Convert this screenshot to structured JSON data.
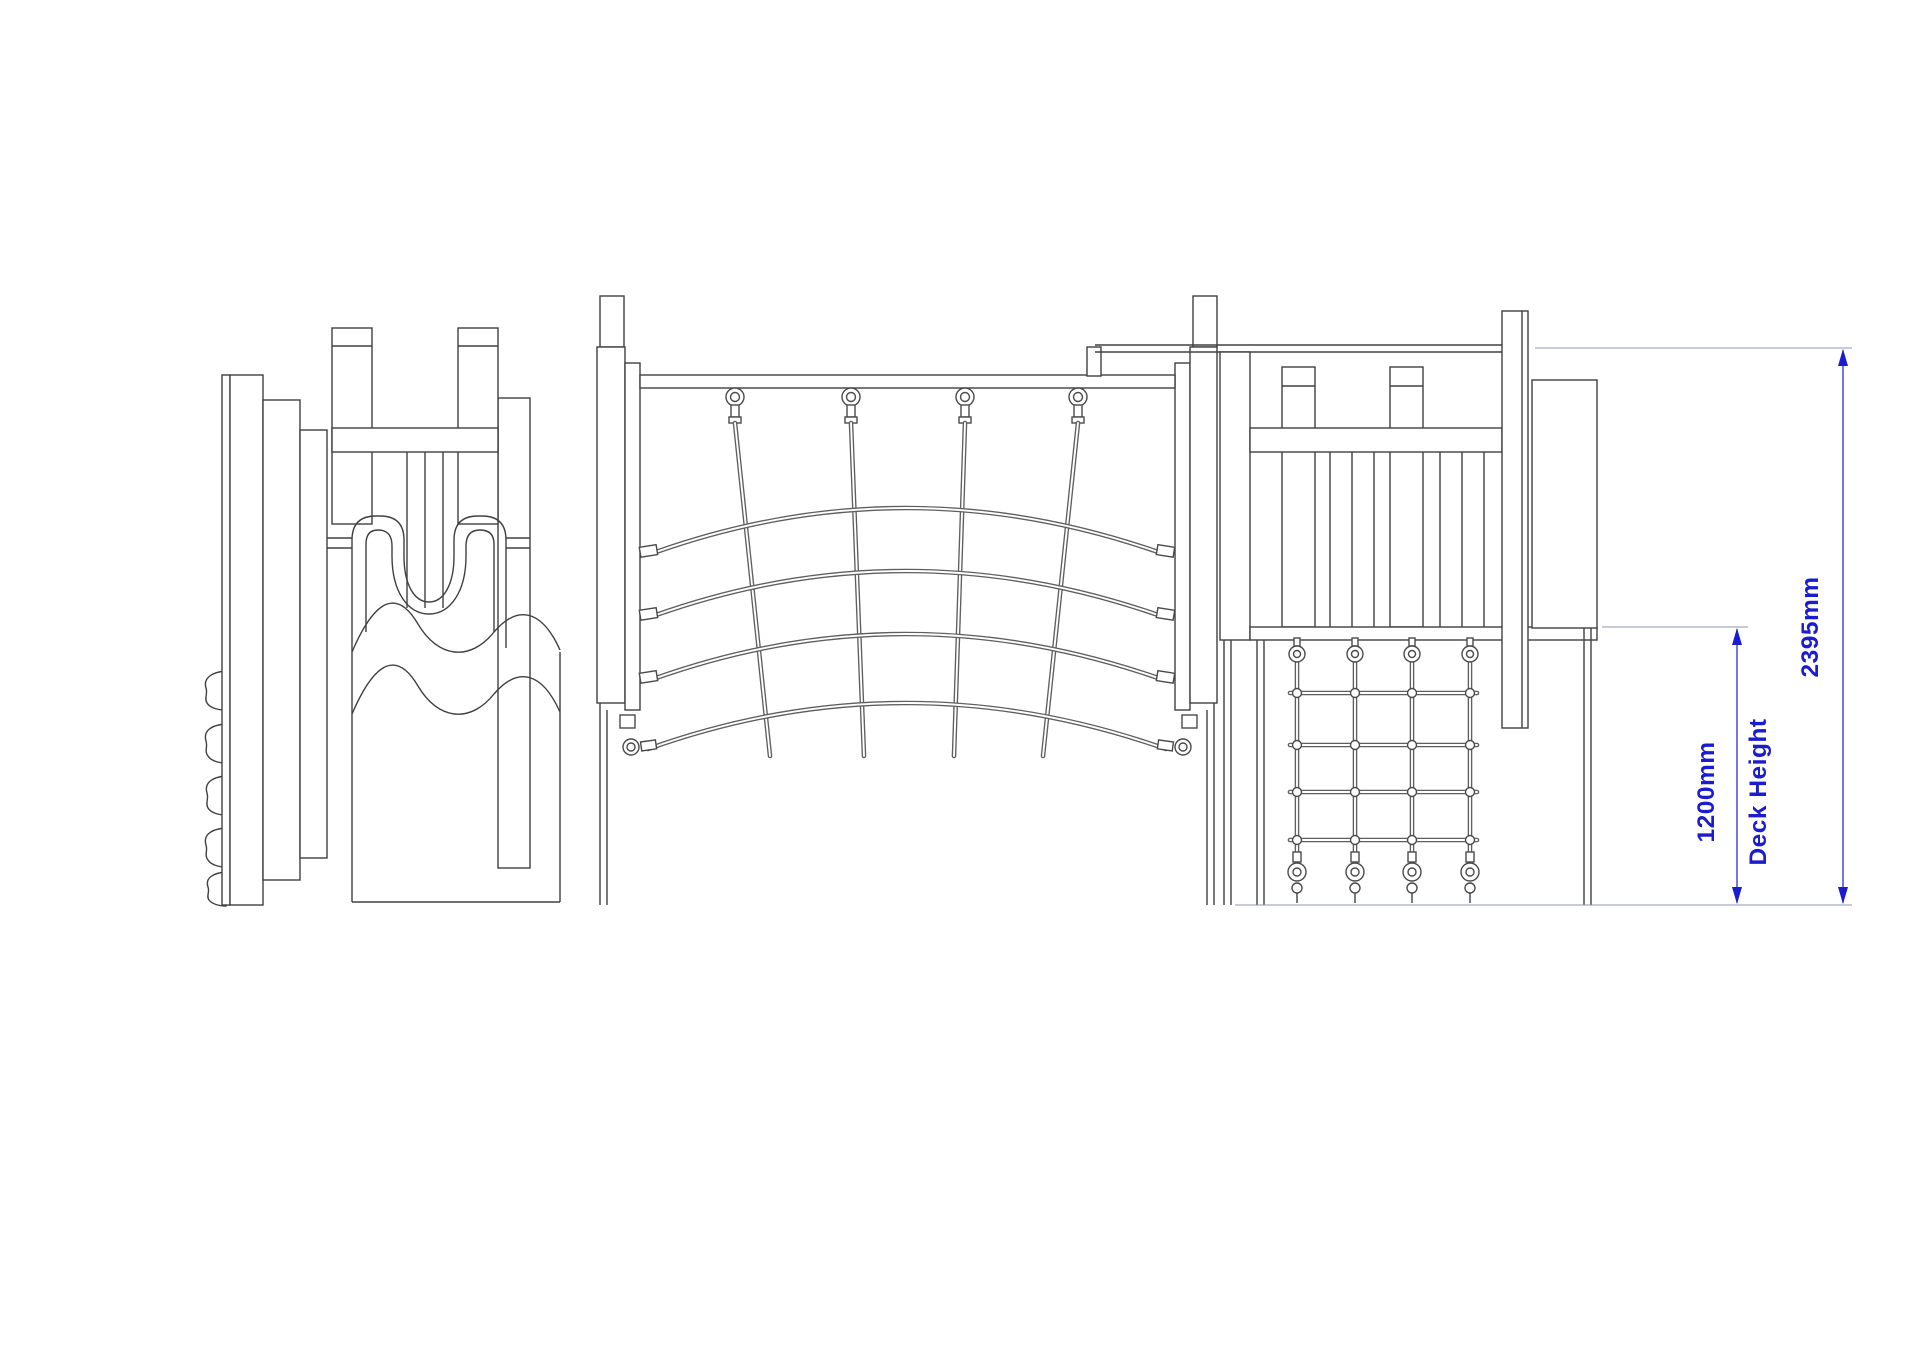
{
  "page": {
    "background_color": "#ffffff",
    "description_visible_content_only": true
  },
  "drawing": {
    "view": "side-elevation-line-drawing",
    "line_color": "#404040",
    "rope_color": "#5f5f5f",
    "dimension_color": "#1b1bd0",
    "extension_line_color": "#8d96b8",
    "components": [
      "wave-slide-tower",
      "climbing-holds",
      "curved-rope-bridge",
      "net-tower",
      "climbing-net"
    ],
    "dimensions": {
      "overall_height_label": "2395mm",
      "deck_height_value_label": "1200mm",
      "deck_height_name_label": "Deck Height"
    }
  }
}
